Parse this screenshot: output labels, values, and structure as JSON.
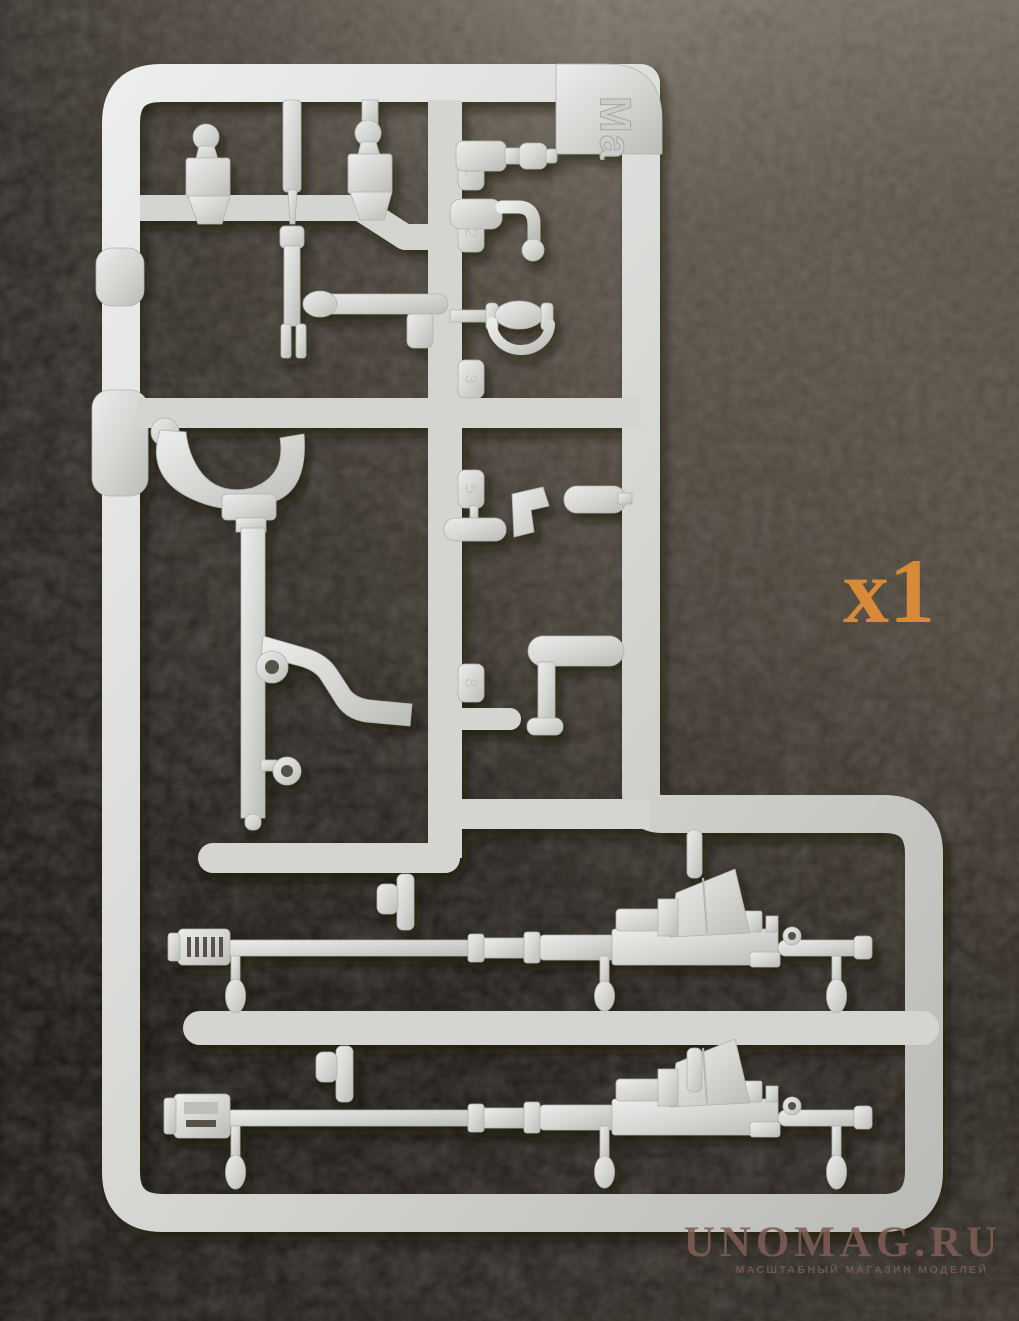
{
  "sprue": {
    "gate_letter": "Ma",
    "part_tags": [
      "1",
      "2",
      "3",
      "5",
      "8"
    ],
    "plastic_color": "#d6d7d3",
    "plastic_highlight": "#eceded",
    "plastic_shadow": "#bbbcb7"
  },
  "annotation": {
    "quantity_label": "x1",
    "color": "#d98a38"
  },
  "watermark": {
    "title": "UNOMAG.RU",
    "subtitle": "МАСШТАБНЫЙ МАГАЗИН МОДЕЛЕЙ",
    "color": "#7e5d55"
  },
  "background": {
    "leather_light": "#8a8173",
    "leather_mid": "#675f53",
    "leather_dark": "#2e2822"
  }
}
